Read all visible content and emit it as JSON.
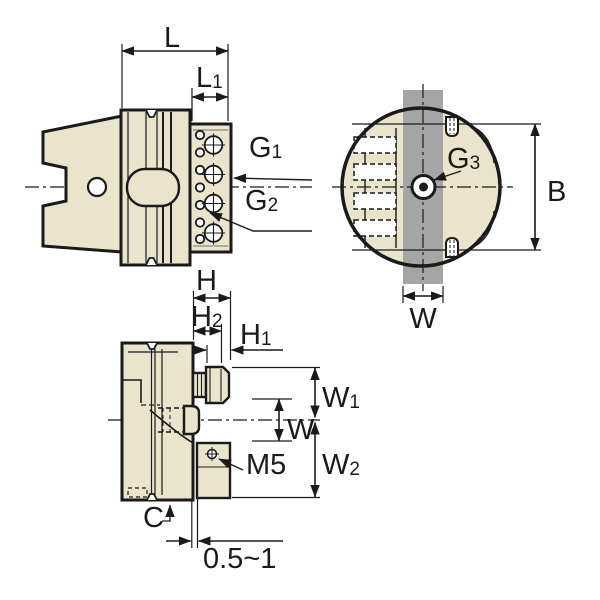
{
  "drawing": {
    "type": "engineering-dimension-drawing",
    "views": {
      "side_view": "tool holder side view",
      "front_view": "tool holder front (circular) view",
      "top_view": "tool holder top view"
    },
    "colors": {
      "body_fill": "#EAE4CC",
      "slot_fill": "#A5A5A5",
      "line": "#1a1a1a",
      "background": "#ffffff"
    }
  },
  "labels": {
    "L": {
      "base": "L",
      "sub": ""
    },
    "L1": {
      "base": "L",
      "sub": "1"
    },
    "G1": {
      "base": "G",
      "sub": "1"
    },
    "G2": {
      "base": "G",
      "sub": "2"
    },
    "G3": {
      "base": "G",
      "sub": "3"
    },
    "B": {
      "base": "B",
      "sub": ""
    },
    "W_front": {
      "base": "W",
      "sub": ""
    },
    "H": {
      "base": "H",
      "sub": ""
    },
    "H2": {
      "base": "H",
      "sub": "2"
    },
    "H1": {
      "base": "H",
      "sub": "1"
    },
    "W1": {
      "base": "W",
      "sub": "1"
    },
    "W_top": {
      "base": "W",
      "sub": ""
    },
    "W2": {
      "base": "W",
      "sub": "2"
    },
    "M5": {
      "base": "M5",
      "sub": ""
    },
    "C": {
      "base": "C",
      "sub": ""
    },
    "gap": {
      "base": "0.5~1",
      "sub": ""
    }
  }
}
